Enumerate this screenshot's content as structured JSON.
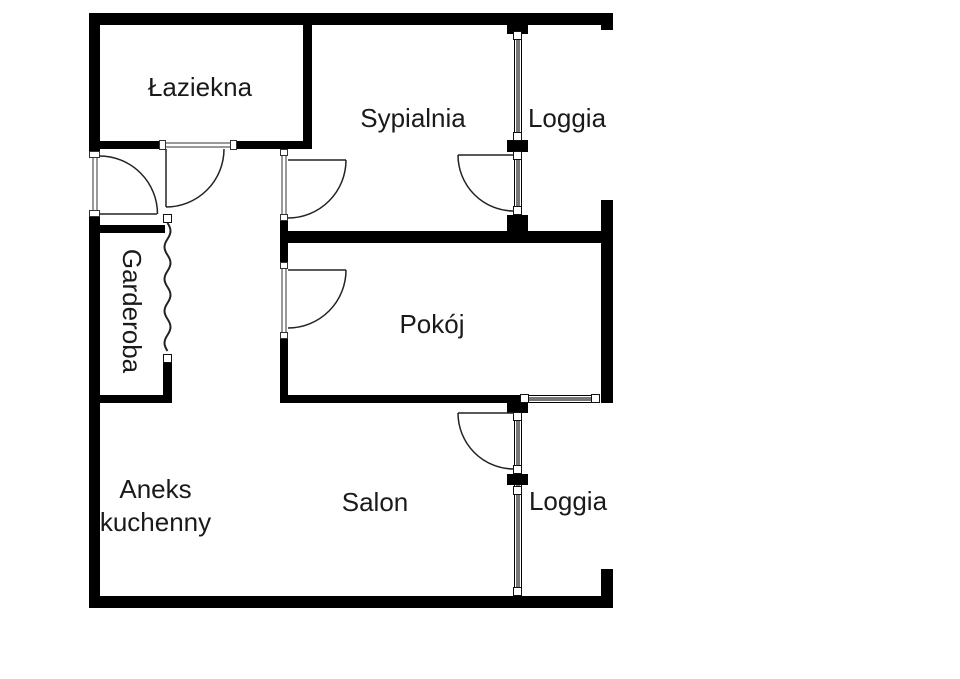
{
  "plan": {
    "kind": "apartment-floor-plan",
    "rooms": {
      "bathroom": {
        "label": "Łaziekna"
      },
      "bedroom": {
        "label": "Sypialnia"
      },
      "loggia_top": {
        "label": "Loggia"
      },
      "wardrobe": {
        "label": "Garderoba"
      },
      "room": {
        "label": "Pokój"
      },
      "kitchenette": {
        "label": "Aneks kuchenny"
      },
      "living_room": {
        "label": "Salon"
      },
      "loggia_bottom": {
        "label": "Loggia"
      }
    },
    "colors": {
      "wall": "#000000",
      "glazing": "#777777",
      "background": "#ffffff",
      "text": "#1a1a1a"
    }
  }
}
